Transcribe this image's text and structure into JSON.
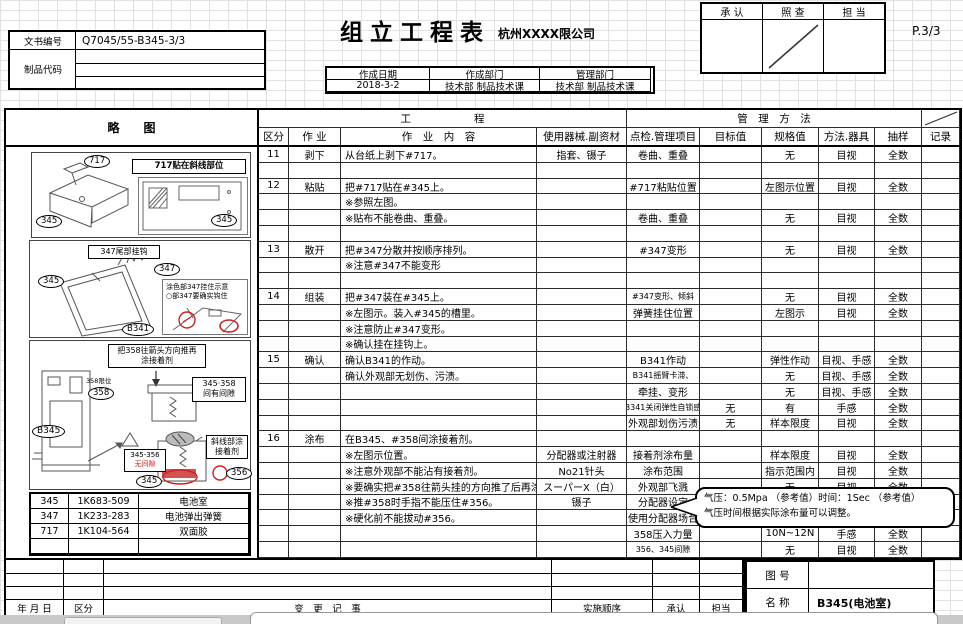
{
  "header": {
    "doc_label": "文书编号",
    "doc_number": "Q7045/55-B345-3/3",
    "product_code_label": "制品代码",
    "title": "组立工程表",
    "company": "杭州XXXX限公司",
    "page": "P.3/3",
    "approval": {
      "approve": "承  认",
      "check": "照  查",
      "charge": "担  当"
    },
    "date_box": {
      "date_label": "作成日期",
      "date": "2018-3-2",
      "dept_label": "作成部门",
      "dept": "技术部  制品技术课",
      "mgmt_label": "管理部门",
      "mgmt": "技术部  制品技术课"
    }
  },
  "sketch": {
    "title": "略　　图",
    "d1": {
      "tape": "717",
      "body": "345",
      "inset_title": "717贴在斜线部位",
      "inset_part": "345"
    },
    "d2": {
      "hook_label": "347尾部挂钩",
      "part_body": "345",
      "part_spring": "347",
      "part_door": "B341",
      "inset_line1": "涂色部347挂住示意",
      "inset_line2": "○部347要确实钩住"
    },
    "d3": {
      "callout_line1": "把358往箭头方向推再",
      "callout_line2": "涂接着剂",
      "pos_label": "358限位",
      "part_358": "358",
      "gap_line1": "345·358",
      "gap_line2": "间有间隙",
      "part_b345": "B345",
      "nogap_box": "345-356",
      "nogap_red": "无间隙",
      "part_345": "345",
      "part_356": "356",
      "glue_line1": "斜线部涂",
      "glue_line2": "接着剂"
    },
    "parts": [
      [
        "345",
        "1K683-509",
        "电池室"
      ],
      [
        "347",
        "1K233-283",
        "电池弹出弹簧"
      ],
      [
        "717",
        "1K104-564",
        "双面胶"
      ],
      [
        "",
        "",
        ""
      ]
    ]
  },
  "process_table": {
    "group_headers": {
      "process": "工　　　　　　程",
      "management": "管　理　方　法"
    },
    "headers": [
      "区分",
      "作 业",
      "作　业　内　容",
      "使用器械.副资材",
      "点检.管理项目",
      "目标值",
      "规格值",
      "方法.器具",
      "抽样",
      "记录"
    ],
    "rows": [
      [
        "11",
        "剥下",
        "从台纸上剥下#717。",
        "指套、镊子",
        "卷曲、重叠",
        "",
        "无",
        "目视",
        "全数",
        ""
      ],
      [
        "",
        "",
        "",
        "",
        "",
        "",
        "",
        "",
        "",
        ""
      ],
      [
        "12",
        "粘贴",
        "把#717贴在#345上。",
        "",
        "#717粘贴位置",
        "",
        "左图示位置",
        "目视",
        "全数",
        ""
      ],
      [
        "",
        "",
        "※参照左图。",
        "",
        "",
        "",
        "",
        "",
        "",
        ""
      ],
      [
        "",
        "",
        "※贴布不能卷曲、重叠。",
        "",
        "卷曲、重叠",
        "",
        "无",
        "目视",
        "全数",
        ""
      ],
      [
        "",
        "",
        "",
        "",
        "",
        "",
        "",
        "",
        "",
        ""
      ],
      [
        "13",
        "散开",
        "把#347分散并按顺序排列。",
        "",
        "#347变形",
        "",
        "无",
        "目视",
        "全数",
        ""
      ],
      [
        "",
        "",
        "※注意#347不能变形",
        "",
        "",
        "",
        "",
        "",
        "",
        ""
      ],
      [
        "",
        "",
        "",
        "",
        "",
        "",
        "",
        "",
        "",
        ""
      ],
      [
        "14",
        "组装",
        "把#347装在#345上。",
        "",
        "#347变形、倾斜",
        "",
        "无",
        "目视",
        "全数",
        ""
      ],
      [
        "",
        "",
        "※左图示。装入#345的槽里。",
        "",
        "弹簧挂住位置",
        "",
        "左图示",
        "目视",
        "全数",
        ""
      ],
      [
        "",
        "",
        "※注意防止#347变形。",
        "",
        "",
        "",
        "",
        "",
        "",
        ""
      ],
      [
        "",
        "",
        "※确认挂在挂钩上。",
        "",
        "",
        "",
        "",
        "",
        "",
        ""
      ],
      [
        "15",
        "确认",
        "确认B341的作动。",
        "",
        "B341作动",
        "",
        "弹性作动",
        "目视、手感",
        "全数",
        ""
      ],
      [
        "",
        "",
        "确认外观部无划伤、污渍。",
        "",
        "B341摇臂卡滞、",
        "",
        "无",
        "目视、手感",
        "全数",
        ""
      ],
      [
        "",
        "",
        "",
        "",
        "牵挂、变形",
        "",
        "无",
        "目视、手感",
        "全数",
        ""
      ],
      [
        "",
        "",
        "",
        "",
        "B341关闭弹性自锁感",
        "无",
        "有",
        "手感",
        "全数",
        ""
      ],
      [
        "",
        "",
        "",
        "",
        "外观部划伤污渍",
        "无",
        "样本限度",
        "目视",
        "全数",
        ""
      ],
      [
        "16",
        "涂布",
        "在B345、#358间涂接着剂。",
        "",
        "",
        "",
        "",
        "",
        "",
        ""
      ],
      [
        "",
        "",
        "※左图示位置。",
        "分配器或注射器",
        "接着剂涂布量",
        "",
        "样本限度",
        "目视",
        "全数",
        ""
      ],
      [
        "",
        "",
        "※注意外观部不能沾有接着剂。",
        "No21针头",
        "涂布范围",
        "",
        "指示范围内",
        "目视",
        "全数",
        ""
      ],
      [
        "",
        "",
        "※要确实把#358往箭头挂的方向推了后再涂",
        "スーパーX（白）",
        "外观部飞溅",
        "",
        "无",
        "目视",
        "全数",
        ""
      ],
      [
        "",
        "",
        "※推#358时手指不能压住#356。",
        "镊子",
        "分配器设定",
        "",
        "",
        "",
        "",
        ""
      ],
      [
        "",
        "",
        "※硬化前不能拔动#356。",
        "",
        "使用分配器场合",
        "",
        "",
        "",
        "",
        ""
      ],
      [
        "",
        "",
        "",
        "",
        "358压入力量",
        "",
        "10N~12N",
        "手感",
        "全数",
        ""
      ],
      [
        "",
        "",
        "",
        "",
        "356、345间隙",
        "",
        "无",
        "目视",
        "全数",
        ""
      ]
    ]
  },
  "callout": {
    "line1": "气压：0.5Mpa （参考值）时间：1Sec （参考值）",
    "line2": "气压时间根据实际涂布量可以调整。"
  },
  "revision": {
    "headers": [
      "年 月 日",
      "区分",
      "变　更　记　事",
      "实施顺序",
      "承认",
      "担当"
    ]
  },
  "title_block": {
    "drawing_no_label": "图  号",
    "drawing_no": "",
    "name_label": "名  称",
    "name": "B345(电池室)"
  }
}
